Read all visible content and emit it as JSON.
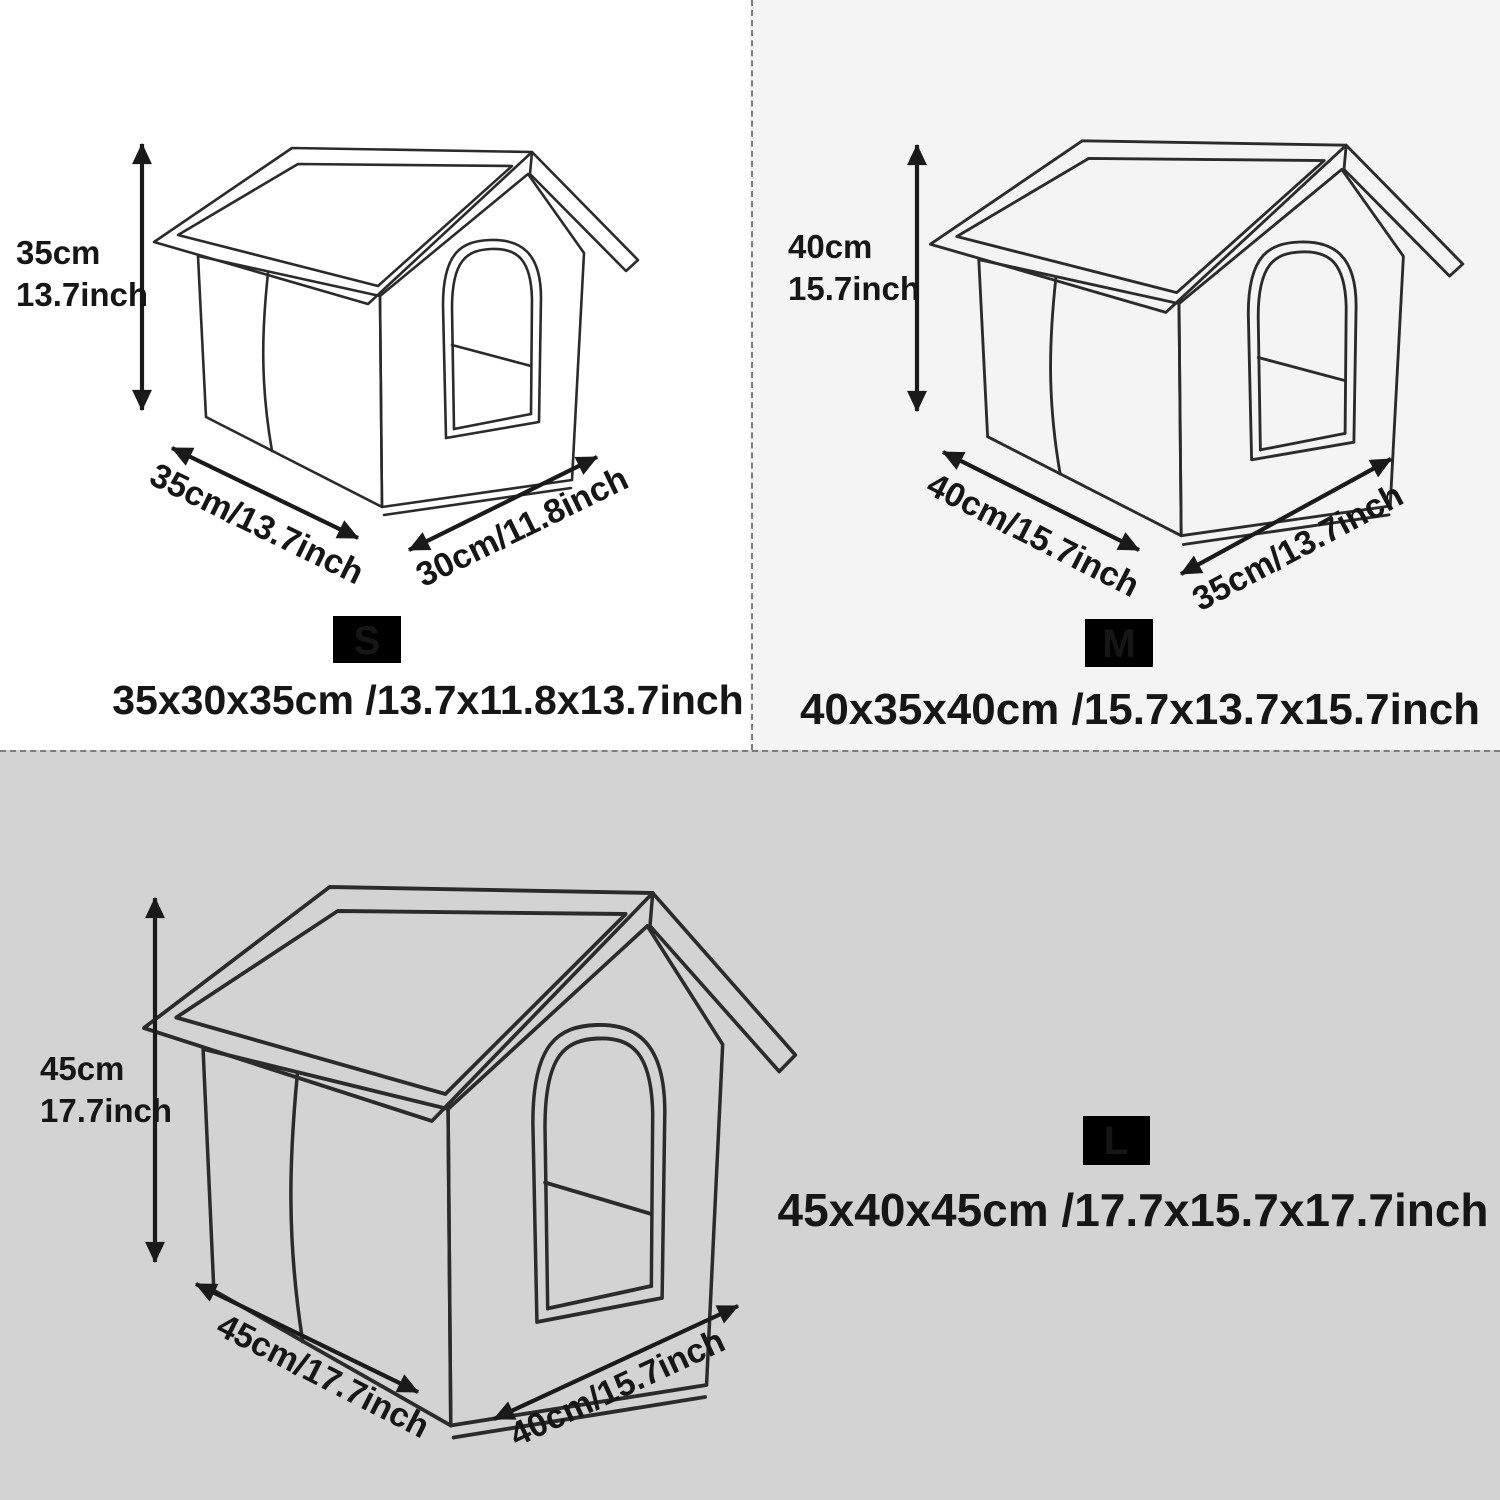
{
  "palette": {
    "panel_s_bg": "#ffffff",
    "panel_m_bg": "#f4f4f4",
    "panel_l_bg": "#d3d3d3",
    "line_ink": "#2b2b2b",
    "arrow_ink": "#1a1a1a",
    "divider": "#7d7d7d",
    "badge_bg": "#000000",
    "badge_fg": "#ffffff"
  },
  "panels": [
    {
      "size_code": "S",
      "bg": "#ffffff",
      "height_cm": "35cm",
      "height_inch": "13.7inch",
      "width_label": "35cm/13.7inch",
      "depth_label": "30cm/11.8inch",
      "dimensions": "35x30x35cm /13.7x11.8x13.7inch"
    },
    {
      "size_code": "M",
      "bg": "#f4f4f4",
      "height_cm": "40cm",
      "height_inch": "15.7inch",
      "width_label": "40cm/15.7inch",
      "depth_label": "35cm/13.7inch",
      "dimensions": "40x35x40cm /15.7x13.7x15.7inch"
    },
    {
      "size_code": "L",
      "bg": "#d3d3d3",
      "height_cm": "45cm",
      "height_inch": "17.7inch",
      "width_label": "45cm/17.7inch",
      "depth_label": "40cm/15.7inch",
      "dimensions": "45x40x45cm /17.7x15.7x17.7inch"
    }
  ]
}
